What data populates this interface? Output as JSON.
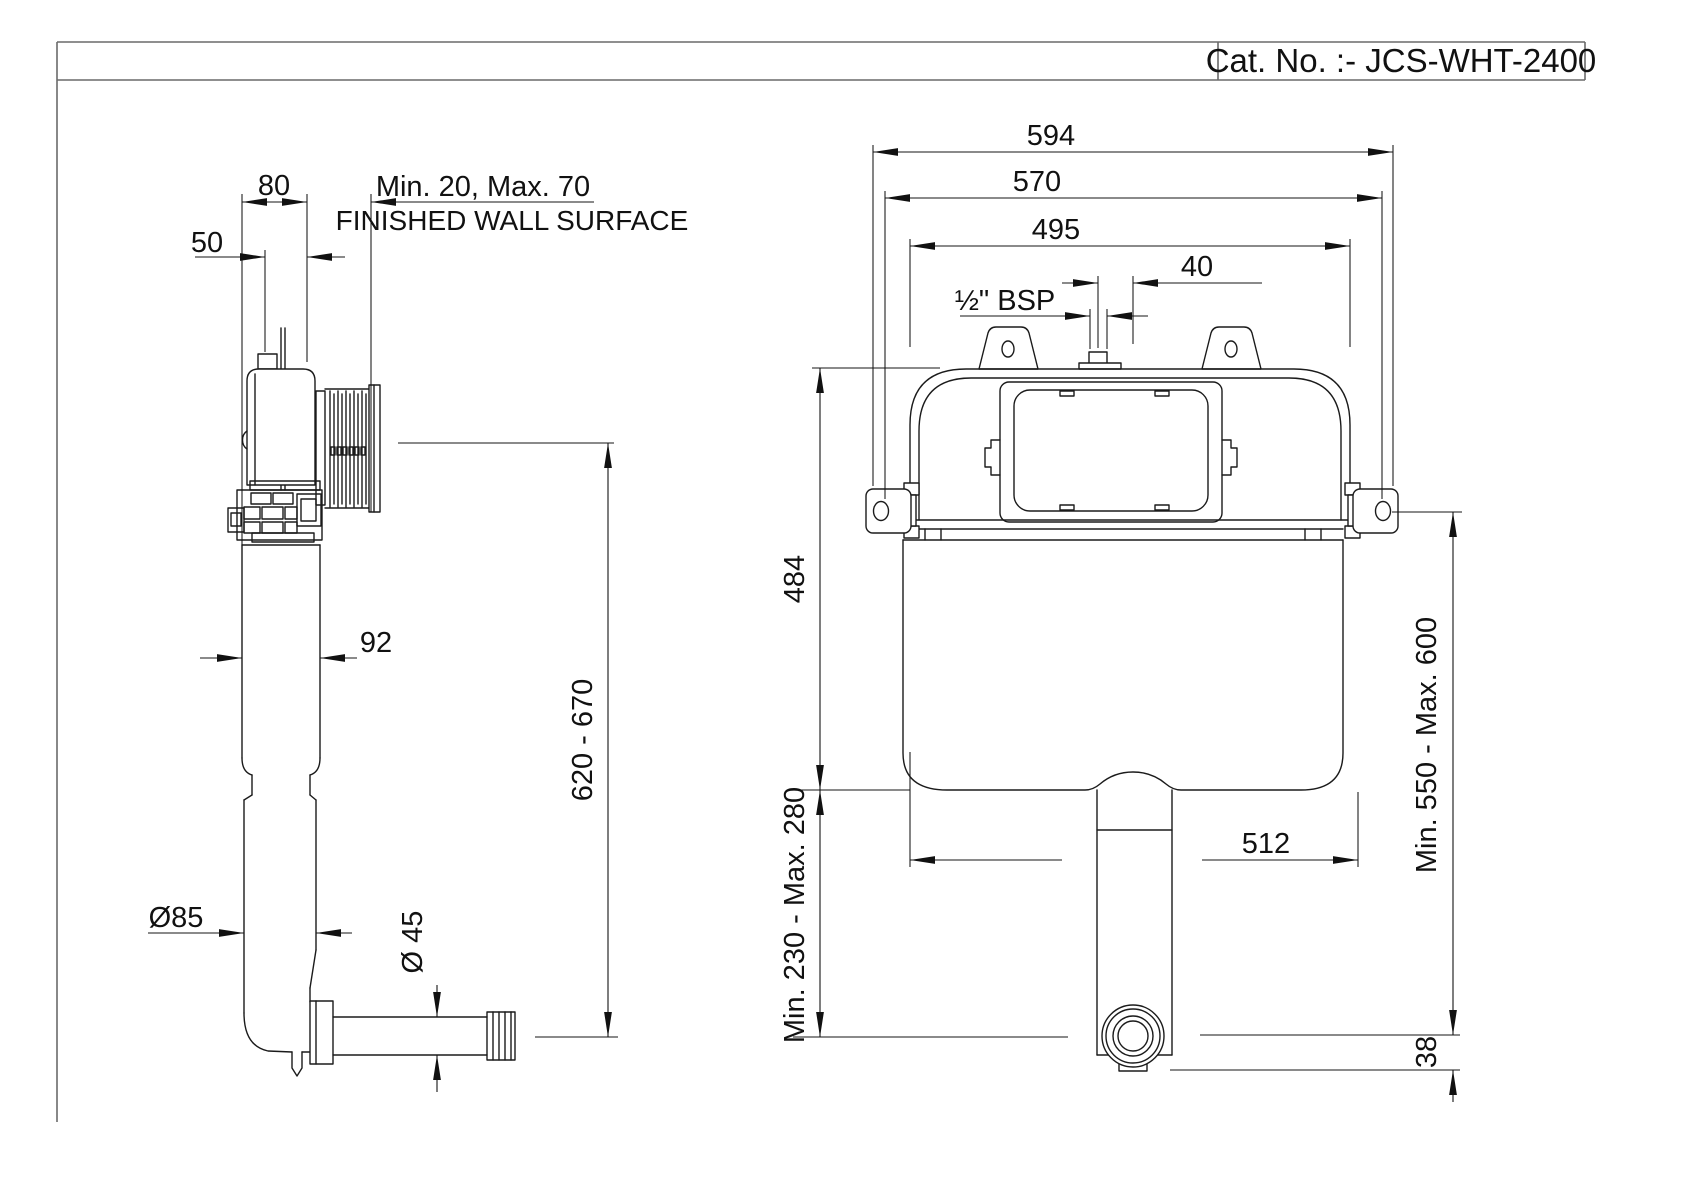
{
  "title_block": {
    "cat_no": "Cat. No. :- JCS-WHT-2400"
  },
  "side_view": {
    "dim_width_body": "80",
    "dim_rod_offset": "50",
    "wall_range_note": "Min. 20, Max. 70",
    "wall_surface_note": "FINISHED WALL SURFACE",
    "dim_pipe_width": "92",
    "dim_pipe_dia": "Ø85",
    "dim_outlet_dia": "Ø 45",
    "dim_height_range": "620 - 670"
  },
  "front_view": {
    "dim_overall_width": "594",
    "dim_bracket_centers": "570",
    "dim_body_width": "495",
    "dim_inlet_offset": "40",
    "inlet_thread_label": "½\" BSP",
    "dim_body_height": "484",
    "dim_outlet_drop_range": "Min. 230 - Max. 280",
    "dim_base_width": "512",
    "dim_mount_height_range": "Min. 550 - Max. 600",
    "dim_outlet_stub": "38"
  }
}
